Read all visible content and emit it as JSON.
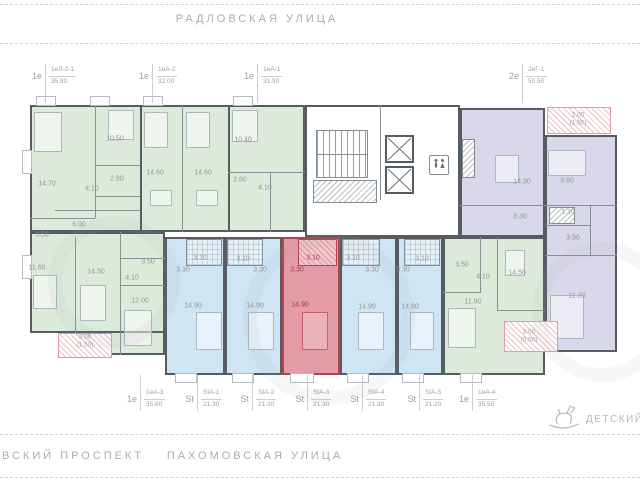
{
  "streets": {
    "top": "РАДЛОВСКАЯ УЛИЦА",
    "bottom_left": "ВСКИЙ ПРОСПЕКТ",
    "bottom_center": "ПАХОМОВСКАЯ УЛИЦА"
  },
  "landmark": {
    "label": "ДЕТСКИЙ",
    "icon": "rocking-horse-icon"
  },
  "units_top": [
    {
      "type": "1е",
      "code": "1еЛ-2-1",
      "area": "35.80"
    },
    {
      "type": "1е",
      "code": "1еА-2",
      "area": "32.00"
    },
    {
      "type": "1е",
      "code": "1еА-1",
      "area": "31.90"
    },
    {
      "type": "2е",
      "code": "2еГ-1",
      "area": "50.50"
    }
  ],
  "units_bottom": [
    {
      "type": "1е",
      "code": "1еА-3",
      "area": "35.60"
    },
    {
      "type": "St",
      "code": "StА-1",
      "area": "21.30"
    },
    {
      "type": "St",
      "code": "StА-2",
      "area": "21.30"
    },
    {
      "type": "St",
      "code": "StА-3",
      "area": "21.30",
      "highlighted": true
    },
    {
      "type": "St",
      "code": "StА-4",
      "area": "21.30"
    },
    {
      "type": "St",
      "code": "StА-5",
      "area": "21.20"
    },
    {
      "type": "1е",
      "code": "1еА-4",
      "area": "35.50"
    }
  ],
  "rooms": [
    "14.70",
    "10.50",
    "2.80",
    "4.10",
    "6.00",
    "3.50",
    "14.60",
    "14.60",
    "10.40",
    "2.80",
    "4.10",
    "11.60",
    "14.50",
    "3.50",
    "4.10",
    "12.00",
    "3.10",
    "3.30",
    "14.90",
    "3.10",
    "3.30",
    "14.90",
    "3.10",
    "3.30",
    "14.90",
    "3.10",
    "3.30",
    "14.90",
    "3.10",
    "3.30",
    "14.80",
    "3.50",
    "4.10",
    "14.50",
    "11.90",
    "14.30",
    "9.80",
    "8.30",
    "1.10",
    "3.90",
    "11.20"
  ],
  "balconies": [
    {
      "area": "3.00",
      "note": "(1.50)"
    },
    {
      "area": "3.00",
      "note": "(0.50)"
    },
    {
      "area": "1.00",
      "note": "(1.50)"
    }
  ],
  "icons": {
    "wc": "wc-sign-icon",
    "elevator": "elevator-x-icon",
    "stairs": "staircase"
  },
  "colors": {
    "green": "#dcebd9",
    "blue": "#cfe5f4",
    "red_fill": "#e39ba5",
    "red_wall": "#b2424e",
    "purple": "#d8d8ea",
    "wall": "#565d62"
  }
}
